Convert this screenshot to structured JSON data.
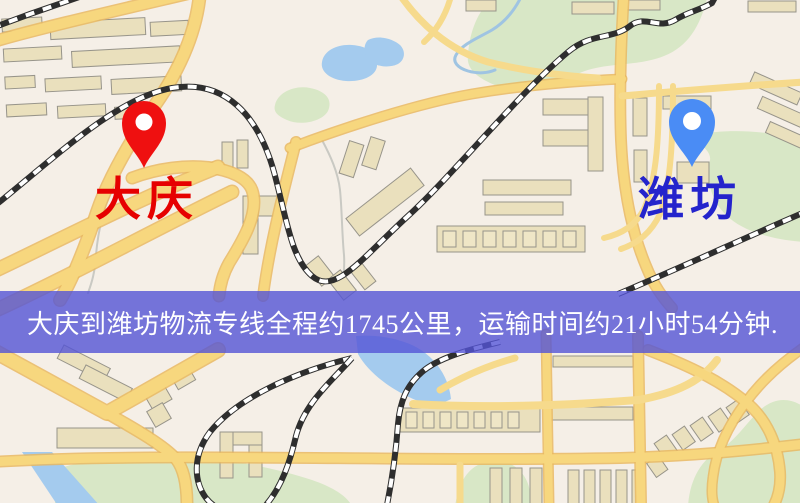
{
  "banner": {
    "text": "大庆到潍坊物流专线全程约1745公里，运输时间约21小时54分钟."
  },
  "route_info": {
    "origin": "大庆",
    "destination": "潍坊",
    "service": "物流专线",
    "distance_km": 1745,
    "duration_hours": 21,
    "duration_minutes": 54
  },
  "markers": {
    "origin": {
      "label": "大庆"
    },
    "destination": {
      "label": "潍坊"
    }
  },
  "theme": {
    "map_bg": "#f5efe7",
    "road_fill": "#f7d77e",
    "road_casing": "#e9b862",
    "rail": "#2e2e2e",
    "water": "#a4cbee",
    "green": "#d8e7c6",
    "building": "#eae0bd",
    "banner_bg": "rgba(84,84,214,0.80)",
    "banner_text": "#ffffff",
    "origin_label": "#e60000",
    "origin_pin": "#ef1010",
    "dest_label": "#2424cc",
    "dest_pin": "#4a8cf5"
  }
}
